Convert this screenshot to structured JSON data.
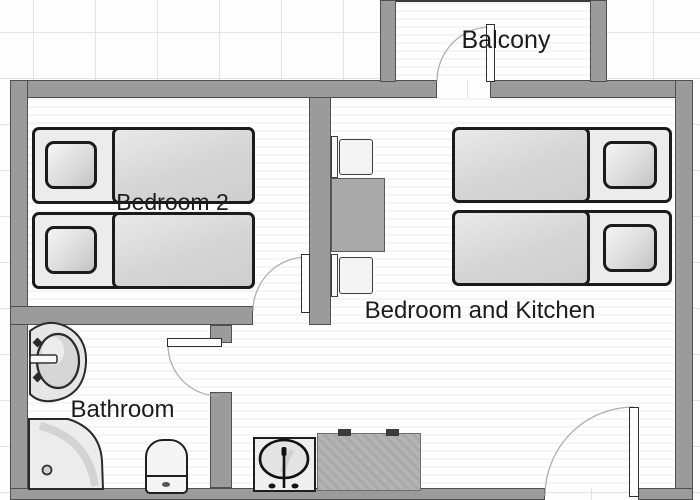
{
  "plan": {
    "title": "Apartment floor plan",
    "rooms": [
      {
        "id": "balcony",
        "label": "Balcony"
      },
      {
        "id": "bedroom2",
        "label": "Bedroom 2"
      },
      {
        "id": "bedroom_kitchen",
        "label": "Bedroom and Kitchen"
      },
      {
        "id": "bathroom",
        "label": "Bathroom"
      }
    ],
    "furniture": [
      "twin-bed",
      "twin-bed",
      "twin-bed",
      "twin-bed",
      "dining-table",
      "chair",
      "chair",
      "bathroom-sink",
      "corner-shower",
      "toilet",
      "kitchen-sink",
      "kitchen-counter"
    ],
    "doors": [
      "balcony-door",
      "bedroom2-door",
      "bathroom-door",
      "entry-door"
    ]
  },
  "colors": {
    "wall": "#9b9b9b",
    "wall_outline": "#4f4f4f",
    "furniture_outline": "#1b1b1b",
    "floor": "#fefefe",
    "grid_line": "#e4e4e4",
    "label_text": "#1c1c1c"
  }
}
